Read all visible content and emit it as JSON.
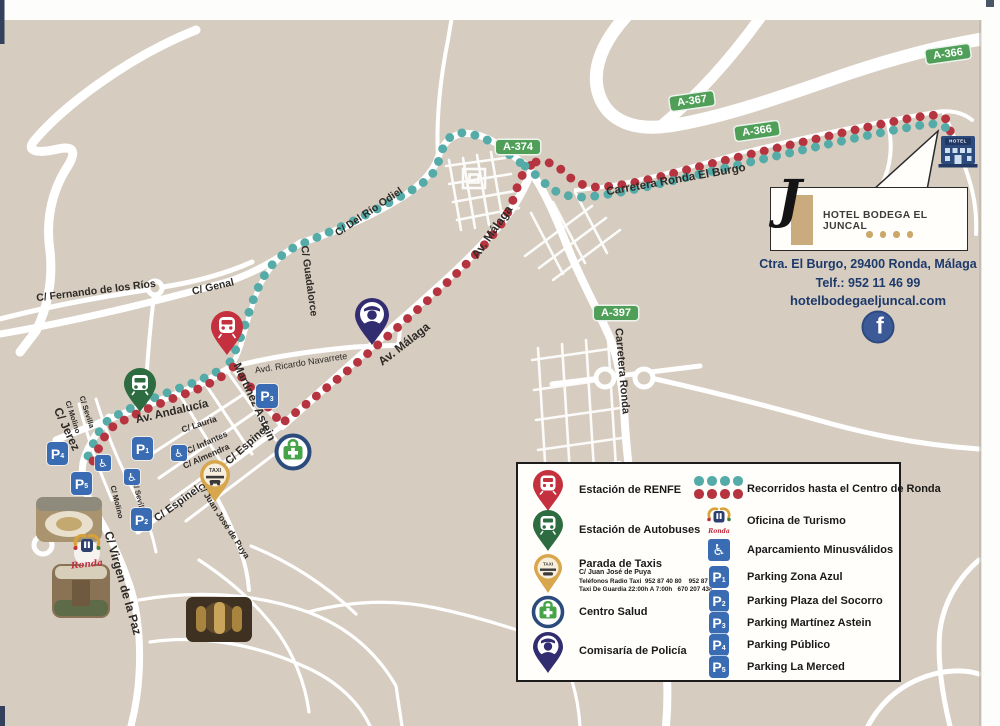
{
  "map": {
    "street_labels": {
      "fernando": "C/ Fernando de los Ríos",
      "genal": "C/ Genal",
      "guadalorce": "C/ Guadalorce",
      "rio_odiel": "C/ Del Río Odiel",
      "carretera_burgo": "Carretera Ronda El Burgo",
      "carretera_ronda": "Carretera Ronda",
      "av_malaga_upper": "Av. Málaga",
      "av_malaga_lower": "Av. Málaga",
      "ricardo_navarrete": "Avd. Ricardo Navarrete",
      "av_andalucia": "Av. Andalucía",
      "martinez_astein": "Martínez Astein",
      "espinel_upper": "C/ Espinel",
      "espinel_lower": "C/ Espinel",
      "jerez": "C/ Jerez",
      "virgen_paz": "C/ Virgen de la Paz",
      "lauria": "C/ Lauria",
      "infantes": "C/ Infantes",
      "almendra": "C/ Almendra",
      "sevilla_upper": "C/ Sevilla",
      "molino_upper": "C/ Molino",
      "sevilla_lower": "C/ Sevilla",
      "molino_lower": "C/ Molino",
      "juan_jose_puya": "C/ Juan José de Puya"
    },
    "road_badges": {
      "a374": "A-374",
      "a367": "A-367",
      "a366_mid": "A-366",
      "a366_top": "A-366",
      "a397": "A-397"
    },
    "parkings": [
      {
        "letter": "P",
        "number": "1"
      },
      {
        "letter": "P",
        "number": "2"
      },
      {
        "letter": "P",
        "number": "3"
      },
      {
        "letter": "P",
        "number": "4"
      },
      {
        "letter": "P",
        "number": "5"
      }
    ],
    "taxi_pin_label": "TAXI",
    "hotel_icon_label": "HOTEL",
    "turismo_script": "Ronda"
  },
  "hotel_panel": {
    "name": "HOTEL BODEGA EL JUNCAL",
    "logo_letter": "J",
    "address": "Ctra. El Burgo, 29400 Ronda, Málaga",
    "phone": "Telf.: 952 11 46 99",
    "website": "hotelbodegaeljuncal.com"
  },
  "legend": {
    "renfe": "Estación de RENFE",
    "bus": "Estación de Autobuses",
    "taxi_title": "Parada de Taxis",
    "taxi_sub": "C/ Juan José de Puya",
    "taxi_line1": "Teléfonos Radio Taxi  952 87 40 80    952 87 23 16",
    "taxi_line2": "Taxi De Guardia 22:00h A 7:00h   670 207 438",
    "salud": "Centro Salud",
    "policia": "Comisaría de Policía",
    "routes": "Recorridos hasta el Centro de Ronda",
    "turismo": "Oficina de Turismo",
    "minusvalidos": "Aparcamiento Minusválidos",
    "p1": "Parking Zona Azul",
    "p2": "Parking Plaza del Socorro",
    "p3": "Parking Martínez Astein",
    "p4": "Parking Público",
    "p5": "Parking La Merced"
  },
  "icons": {
    "wheelchair": "♿",
    "facebook": "f"
  },
  "colors": {
    "map_bg": "#d6ccc0",
    "road_white": "#ffffff",
    "route_teal": "#55aba7",
    "route_red": "#b5343f",
    "parking_blue": "#3a6cb4",
    "badge_green": "#4f9f58",
    "hotel_navy": "#1d3a6b",
    "renfe_red": "#c5303f",
    "bus_green": "#2d6b40",
    "police_navy": "#312d70",
    "taxi_gold": "#d8a64d",
    "facebook_blue": "#3b5a97"
  }
}
